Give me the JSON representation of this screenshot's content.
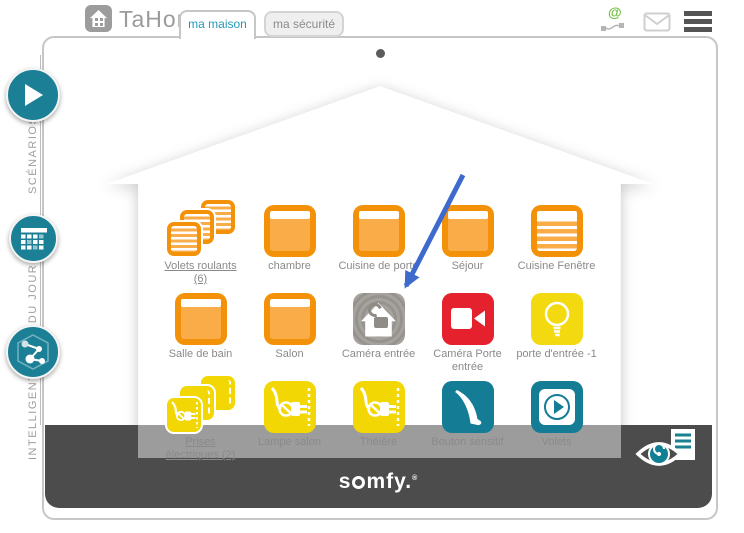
{
  "header": {
    "logo_text": "TaHoma",
    "logo_reg": "®",
    "at_symbol": "@",
    "tabs": [
      {
        "label": "ma maison",
        "active": true
      },
      {
        "label": "ma sécurité",
        "active": false
      }
    ],
    "icons": [
      "at-connection-icon",
      "mail-icon",
      "menu-icon"
    ]
  },
  "sidebar": {
    "items": [
      {
        "label": "SCÉNARIOS",
        "icon": "play-icon"
      },
      {
        "label": "RE DU JOUR",
        "icon": "calendar-grid-icon"
      },
      {
        "label": "INTELLIGENT",
        "icon": "network-icon"
      }
    ]
  },
  "house": {
    "rows": [
      {
        "cells": [
          {
            "label1": "Volets roulants",
            "label2": "(6)",
            "type": "shutter-group",
            "link": true
          },
          {
            "label1": "chambre",
            "label2": "",
            "type": "shutter-open"
          },
          {
            "label1": "Cuisine de porte",
            "label2": "",
            "type": "shutter-open"
          },
          {
            "label1": "Séjour",
            "label2": "",
            "type": "shutter-open"
          },
          {
            "label1": "Cuisine Fenêtre",
            "label2": "",
            "type": "shutter-closed"
          }
        ]
      },
      {
        "cells": [
          {
            "label1": "Salle de bain",
            "label2": "",
            "type": "shutter-open"
          },
          {
            "label1": "Salon",
            "label2": "",
            "type": "shutter-open"
          },
          {
            "label1": "Caméra entrée",
            "label2": "",
            "type": "security-camera-gray",
            "selected": true
          },
          {
            "label1": "Caméra Porte",
            "label2": "entrée",
            "type": "video-camera-red"
          },
          {
            "label1": "porte d'entrée -1",
            "label2": "",
            "type": "light-bulb-yellow"
          }
        ]
      },
      {
        "cells": [
          {
            "label1": "Prises",
            "label2": "électriques (2)",
            "type": "plug-group",
            "link": true
          },
          {
            "label1": "Lampe salon",
            "label2": "",
            "type": "plug-yellow"
          },
          {
            "label1": "Théière",
            "label2": "",
            "type": "plug-yellow"
          },
          {
            "label1": "Bouton sensitif",
            "label2": "",
            "type": "sensitive-button-teal"
          },
          {
            "label1": "Volets",
            "label2": "",
            "type": "shutter-play-teal"
          }
        ]
      }
    ]
  },
  "footer": {
    "brand_pre": "s",
    "brand_post": "mfy.",
    "reg": "®"
  },
  "colors": {
    "teal": "#1b7f96",
    "orange": "#f39208",
    "yellow": "#f2d704",
    "red": "#e5212e",
    "gray_bar": "#4c4c4c",
    "arrow_blue": "#3e6ace",
    "tab_active_text": "#2598ba",
    "at_green": "#72bf44"
  }
}
